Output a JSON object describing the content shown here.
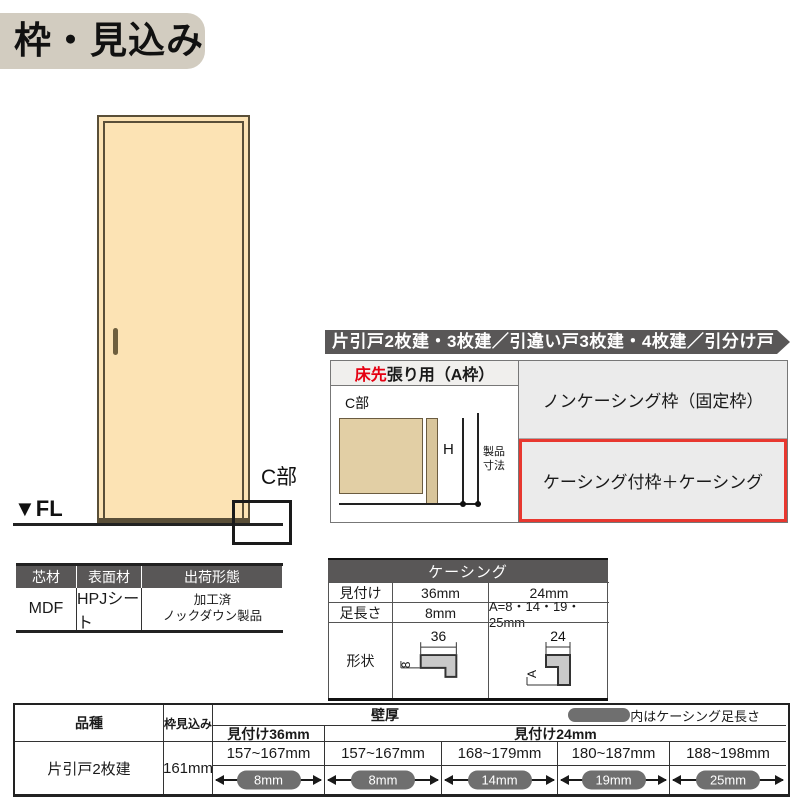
{
  "page_title": "枠・見込み",
  "door_diagram": {
    "fl_label": "▼FL",
    "c_part_label": "C部"
  },
  "banner": {
    "text": "片引戸2枚建・3枚建／引違い戸3枚建・4枚建／引分け戸"
  },
  "frame_table": {
    "header": {
      "red_part": "床先",
      "rest": "張り用（A枠）"
    },
    "diagram": {
      "c_part_label": "C部",
      "height_label": "H",
      "product_dim_line1": "製品",
      "product_dim_line2": "寸法"
    },
    "options": [
      {
        "label": "ノンケーシング枠（固定枠）"
      },
      {
        "label": "ケーシング付枠＋ケーシング"
      }
    ]
  },
  "material_table": {
    "headers": [
      "芯材",
      "表面材",
      "出荷形態"
    ],
    "core": "MDF",
    "surface": "HPJシート",
    "shipping_line1": "加工済",
    "shipping_line2": "ノックダウン製品"
  },
  "casing_table": {
    "title": "ケーシング",
    "mitsuke": {
      "label": "見付け",
      "v36": "36mm",
      "v24": "24mm"
    },
    "ashinagasa": {
      "label": "足長さ",
      "v36": "8mm",
      "v24": "A=8・14・19・25mm"
    },
    "keijo": {
      "label": "形状",
      "dim36_top": "36",
      "dim36_side": "8",
      "dim24_top": "24",
      "dim24_side": "A"
    }
  },
  "spec_table": {
    "header_hinshu": "品種",
    "header_mikomi": "枠見込み",
    "header_kabeatsu": "壁厚",
    "header_note": "内はケーシング足長さ",
    "sub_header_36": "見付け36mm",
    "sub_header_24": "見付け24mm",
    "row": {
      "hinshu": "片引戸2枚建",
      "mikomi": "161mm",
      "cells": [
        {
          "range": "157~167mm",
          "casing_leg": "8mm"
        },
        {
          "range": "157~167mm",
          "casing_leg": "8mm"
        },
        {
          "range": "168~179mm",
          "casing_leg": "14mm"
        },
        {
          "range": "180~187mm",
          "casing_leg": "19mm"
        },
        {
          "range": "188~198mm",
          "casing_leg": "25mm"
        }
      ]
    }
  },
  "colors": {
    "accent_red": "#e50012",
    "dark_header": "#595757",
    "door_fill": "#fce3b4",
    "pill_gray": "#6f6f6f",
    "cell_gray": "#ebebeb",
    "title_bg": "#d2ccc0"
  }
}
